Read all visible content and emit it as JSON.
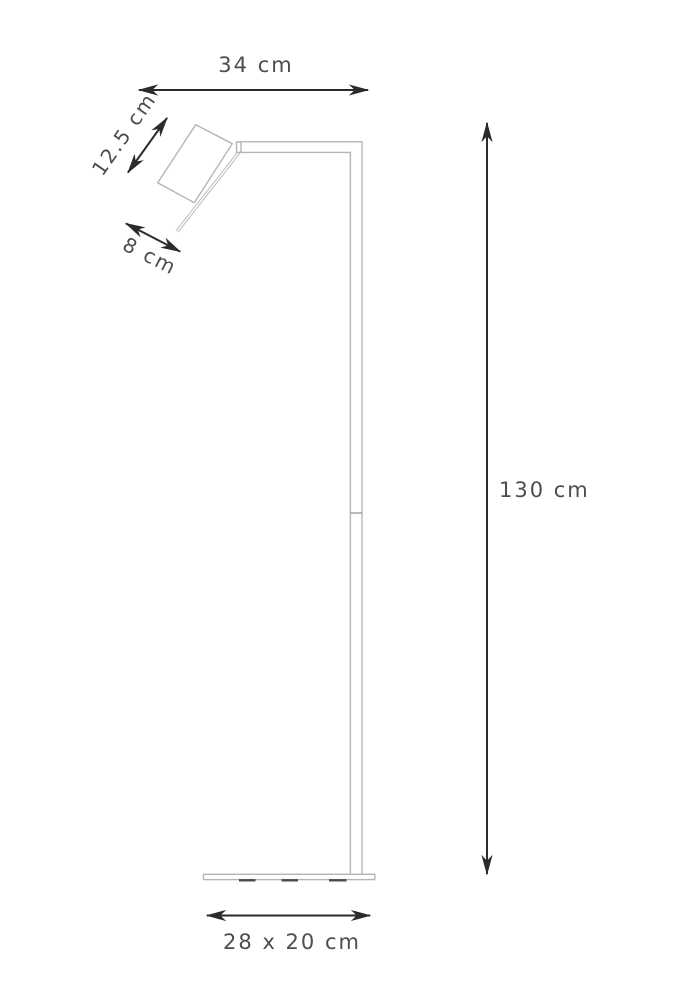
{
  "labels": {
    "arm_width": "34 cm",
    "head_height": "12.5 cm",
    "head_width": "8 cm",
    "lamp_height": "130 cm",
    "base_size": "28 x 20 cm"
  },
  "colors": {
    "background": "#ffffff",
    "lamp_outline": "#b3b5b7",
    "dimension": "#2b2b2b",
    "label_text": "#4d4d4d"
  }
}
